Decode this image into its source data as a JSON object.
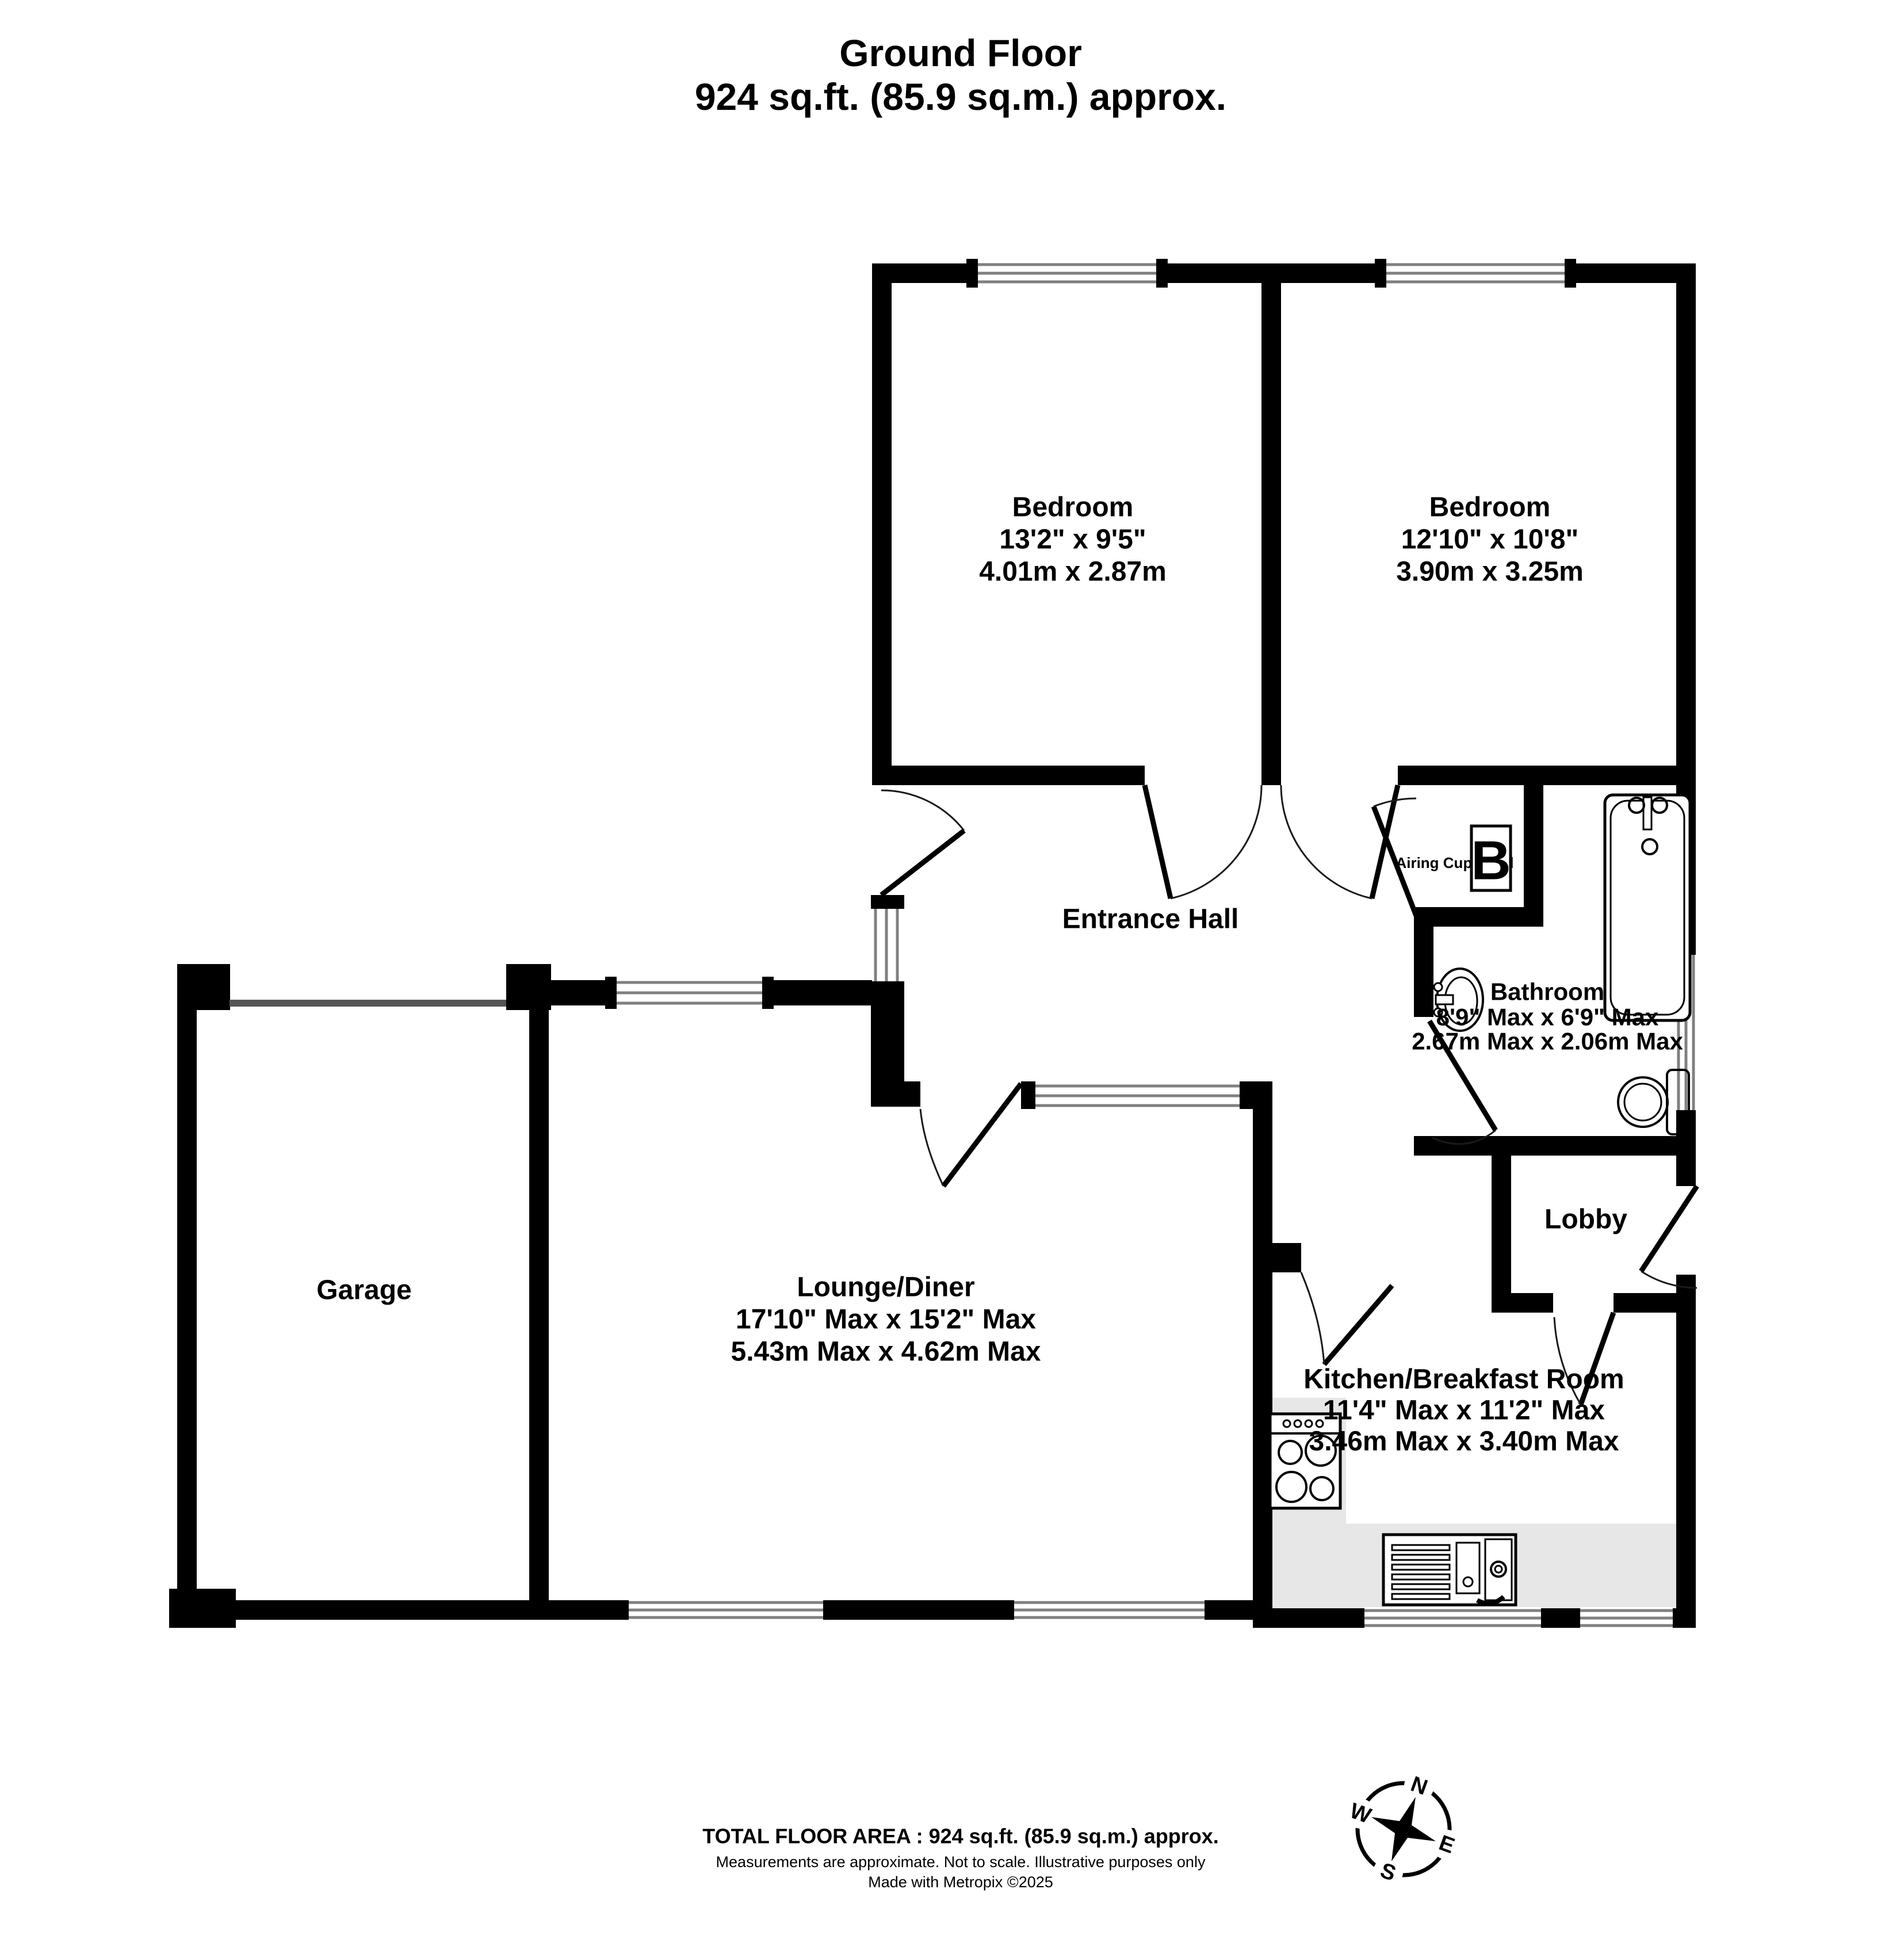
{
  "title": {
    "line1": "Ground Floor",
    "line2": "924 sq.ft. (85.9 sq.m.) approx."
  },
  "rooms": {
    "bedroom1": {
      "name": "Bedroom",
      "imperial": "13'2\" x 9'5\"",
      "metric": "4.01m x 2.87m"
    },
    "bedroom2": {
      "name": "Bedroom",
      "imperial": "12'10\" x 10'8\"",
      "metric": "3.90m x 3.25m"
    },
    "entrance_hall": {
      "name": "Entrance Hall"
    },
    "bathroom": {
      "name": "Bathroom",
      "imperial": "8'9\" Max x 6'9\" Max",
      "metric": "2.67m Max x 2.06m Max"
    },
    "lobby": {
      "name": "Lobby"
    },
    "garage": {
      "name": "Garage"
    },
    "lounge": {
      "name": "Lounge/Diner",
      "imperial": "17'10\" Max x 15'2\" Max",
      "metric": "5.43m Max x 4.62m Max"
    },
    "kitchen": {
      "name": "Kitchen/Breakfast Room",
      "imperial": "11'4\" Max x 11'2\" Max",
      "metric": "3.46m Max x 3.40m Max"
    }
  },
  "airing_cupboard": {
    "label": "Airing Cupboard",
    "boiler_letter": "B"
  },
  "compass": {
    "n": "N",
    "e": "E",
    "s": "S",
    "w": "W"
  },
  "footer": {
    "total": "TOTAL FLOOR AREA : 924 sq.ft. (85.9 sq.m.) approx.",
    "disclaimer": "Measurements are approximate.  Not to scale.  Illustrative purposes only",
    "made_with": "Made with Metropix ©2025"
  },
  "colors": {
    "wall": "#000000",
    "window_line": "#808080",
    "counter": "#e7e7e7",
    "garage_door": "#555555"
  }
}
